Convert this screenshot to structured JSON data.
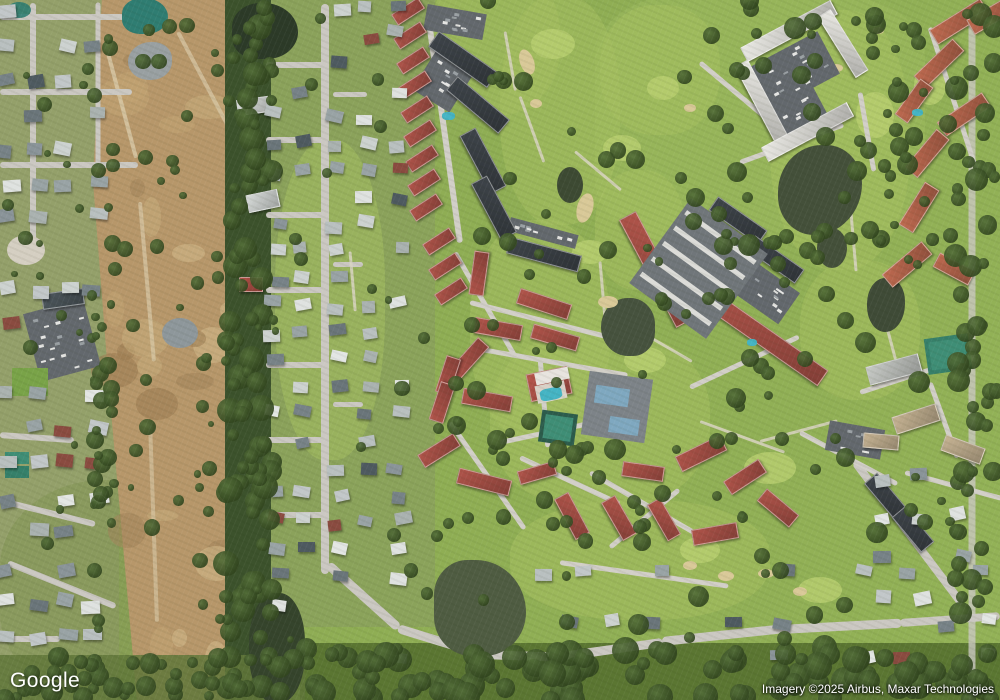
{
  "map": {
    "view_type": "satellite",
    "watermark": "Google",
    "attribution": "Imagery ©2025 Airbus, Maxar Technologies"
  },
  "palette": {
    "grass_base": "#8fa854",
    "fairway_light": "#a6bf60",
    "green_bright": "#b9cf70",
    "tree_dark": "#32461f",
    "tree_mid": "#55703a",
    "dirt": "#b7976a",
    "road": "#cbc8c2",
    "lane": "#d2cfc8",
    "cart_path": "#d8d3c2",
    "red_roof": "#b0544a",
    "orange_roof": "#bf6a50",
    "white_building": "#e9e8e3",
    "dark_roof": "#3e444a",
    "parking": "#63686d",
    "tan_building": "#c6b393",
    "water_teal": "#2f7d72",
    "water_dark": "#47523c",
    "water_gray": "#99a0a2",
    "sand": "#d9c998",
    "tennis_court": "#3f8e76",
    "pool": "#45b4c4"
  }
}
